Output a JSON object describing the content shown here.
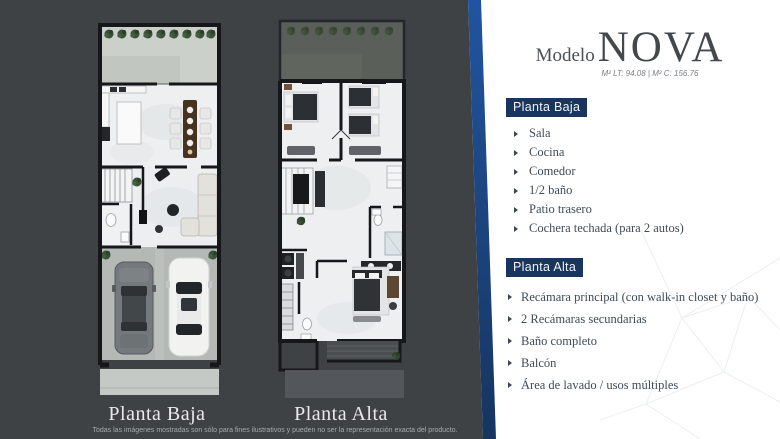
{
  "title": {
    "prefix": "Modelo",
    "name": "NOVA",
    "specs": "M² LT: 94.08 | M² C: 156.76"
  },
  "planta_baja": {
    "heading": "Planta Baja",
    "items": [
      "Sala",
      "Cocina",
      "Comedor",
      "1/2 baño",
      "Patio trasero",
      "Cochera techada (para 2 autos)"
    ]
  },
  "planta_alta": {
    "heading": "Planta Alta",
    "items": [
      "Recámara principal (con walk-in closet y baño)",
      "2 Recámaras  secundarias",
      "Baño completo",
      "Balcón",
      "Área de lavado / usos múltiples"
    ]
  },
  "floorplans": {
    "left_label": "Planta Baja",
    "right_label": "Planta Alta"
  },
  "disclaimer": "Todas las imágenes mostradas son sólo para fines ilustrativos y pueden no ser la representación exacta del producto.",
  "colors": {
    "panel_dark": "#3e4245",
    "stripe_blue": "#2154a0",
    "accent_navy": "#17355e",
    "text_slate": "#3f4b57"
  }
}
